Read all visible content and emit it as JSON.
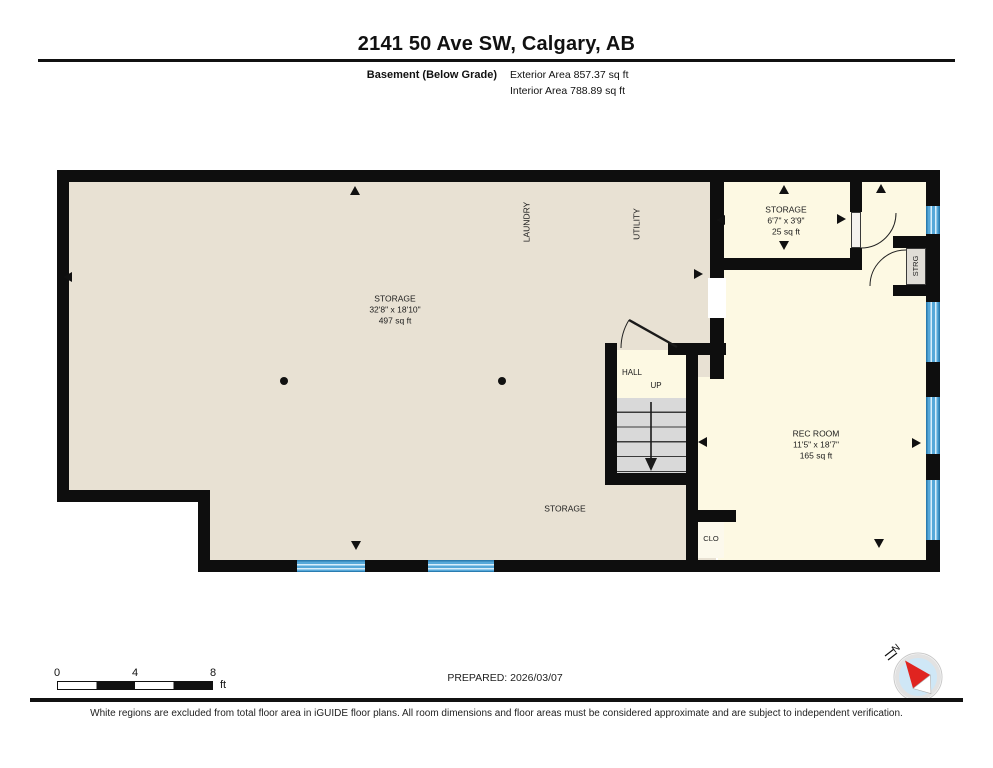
{
  "header": {
    "title": "2141 50 Ave SW, Calgary, AB",
    "floor_label": "Basement (Below Grade)",
    "exterior_area": "Exterior Area 857.37 sq ft",
    "interior_area": "Interior Area 788.89 sq ft"
  },
  "plan": {
    "rooms": {
      "storage_main": {
        "name": "STORAGE",
        "dims": "32'8\" x 18'10\"",
        "area": "497 sq ft"
      },
      "laundry": {
        "name": "LAUNDRY"
      },
      "utility": {
        "name": "UTILITY"
      },
      "storage_small": {
        "name": "STORAGE",
        "dims": "6'7\" x 3'9\"",
        "area": "25 sq ft"
      },
      "hall": {
        "name": "HALL",
        "stair_direction": "UP"
      },
      "rec_room": {
        "name": "REC ROOM",
        "dims": "11'5\" x 18'7\"",
        "area": "165 sq ft"
      },
      "storage_under_stairs": {
        "name": "STORAGE"
      },
      "closet": {
        "name": "CLO"
      },
      "storage_closet": {
        "name": "STRG"
      }
    }
  },
  "scale_bar": {
    "tick_start": "0",
    "tick_mid": "4",
    "tick_end": "8",
    "unit": "ft"
  },
  "prepared": "PREPARED: 2026/03/07",
  "compass": {
    "label": "N"
  },
  "footer": "White regions are excluded from total floor area in iGUIDE floor plans. All room dimensions and floor areas must be considered approximate and are subject to independent verification.",
  "colors": {
    "wall": "#0e0e0e",
    "room_beige": "#e8e1d3",
    "room_cream": "#fdf9e3",
    "window_blue": "#55a8d9",
    "stair_gray": "#d9d9d9",
    "compass_red": "#e02420",
    "compass_blue": "#cfe7f6"
  }
}
